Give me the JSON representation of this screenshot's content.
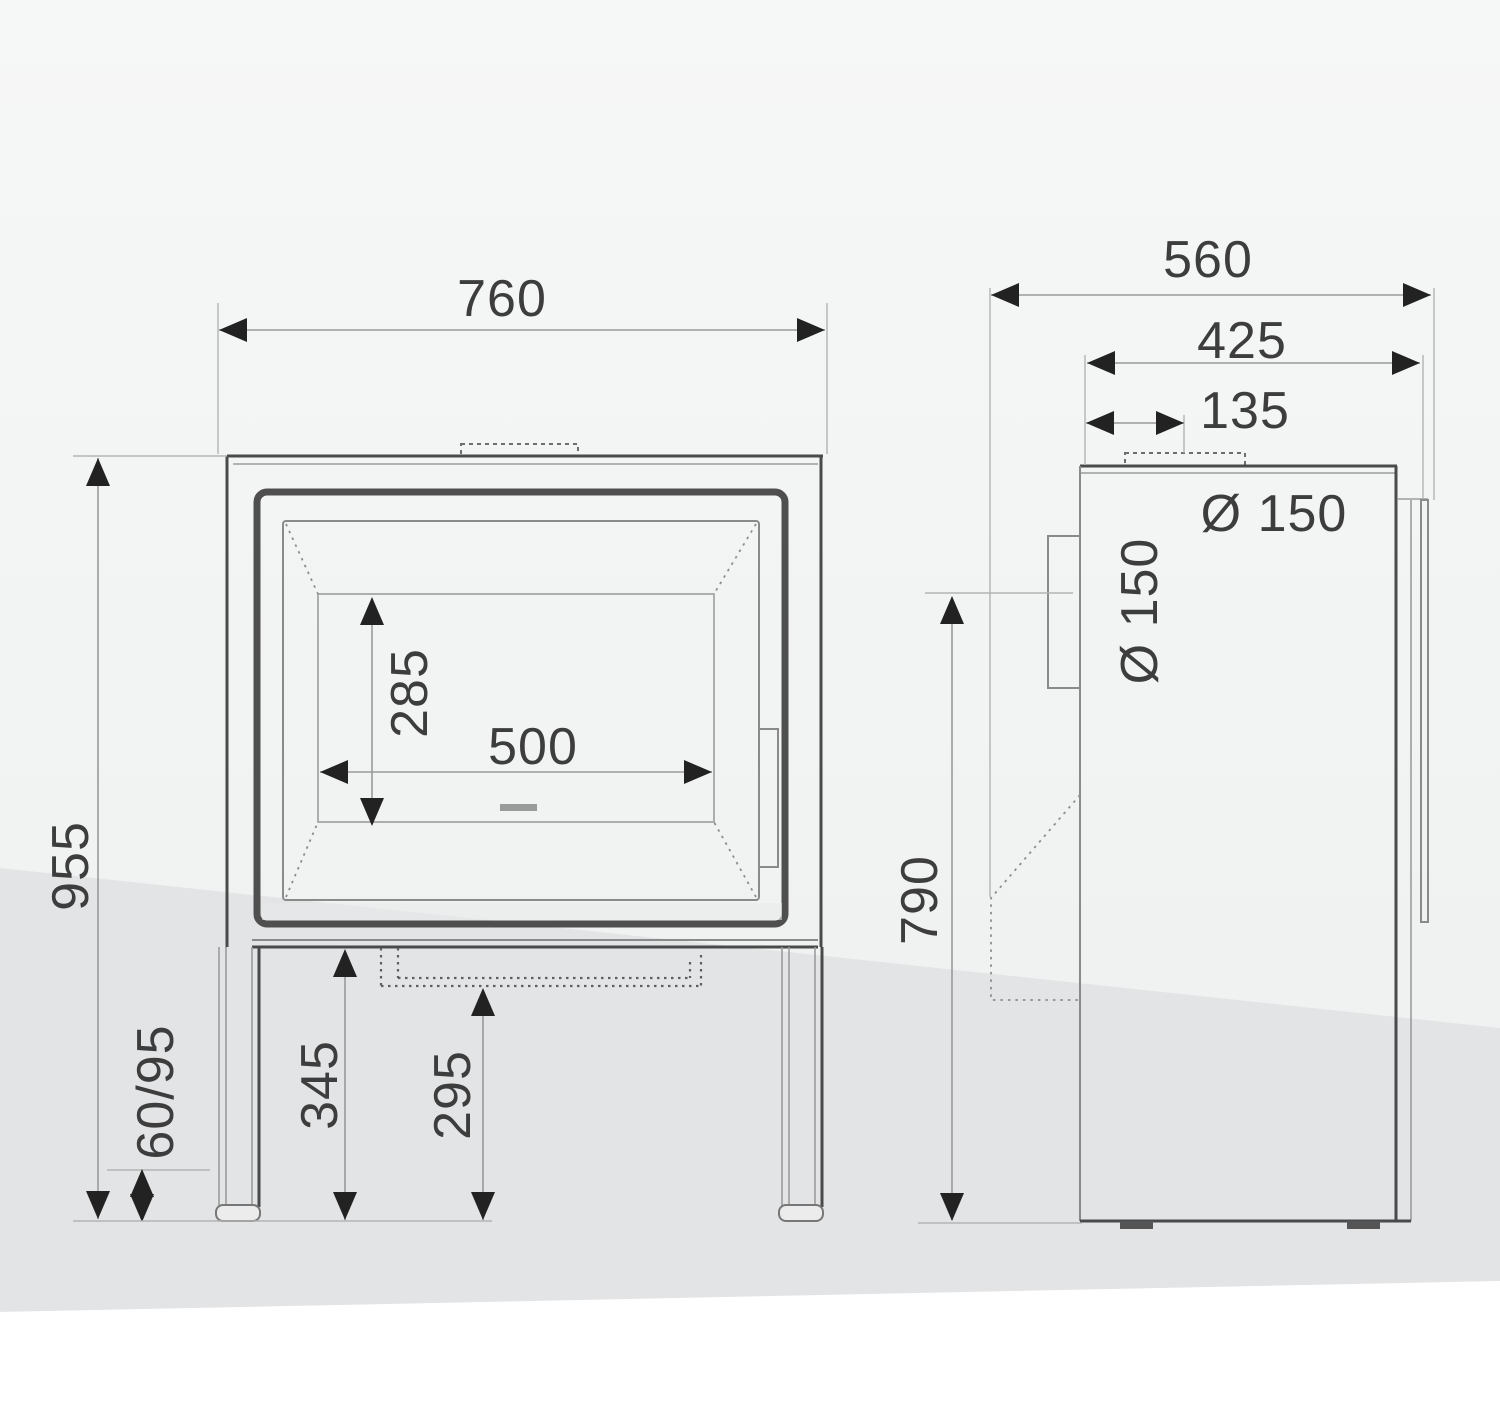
{
  "drawing_title": "stove-dimension-drawing",
  "front_view": {
    "width": "760",
    "overall_height": "955",
    "firebox_width": "500",
    "firebox_height": "285",
    "plinth_height": "345",
    "ash_drawer_height": "295",
    "foot_adjustment": "60/95"
  },
  "side_view": {
    "depth": "560",
    "depth_to_front": "425",
    "flue_center_offset": "135",
    "rear_flue_center_height": "790",
    "top_flue_diameter": "Ø 150",
    "rear_flue_diameter": "Ø 150"
  },
  "colors": {
    "line_dark": "#4a4a4a",
    "line_medium": "#8a8a8a",
    "line_light": "#b3b3b3",
    "text": "#3d3d3d",
    "arrow": "#222222",
    "background_top": "#f4f5f5",
    "background_band": "#e3e4e6",
    "background_bottom": "#ffffff"
  }
}
